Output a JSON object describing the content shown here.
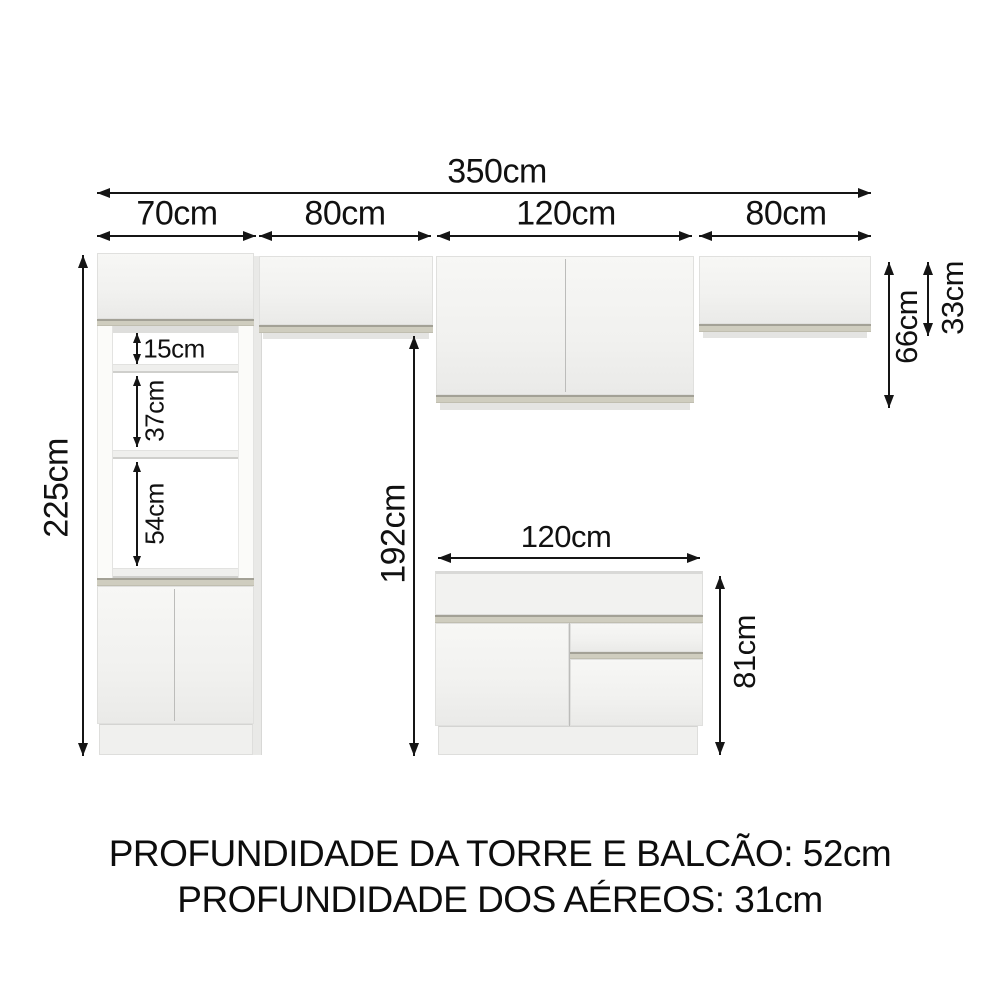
{
  "dims": {
    "total_width": "350cm",
    "tower_width": "70cm",
    "aereo_left_width": "80cm",
    "aereo_center_width": "120cm",
    "aereo_right_width": "80cm",
    "tower_height": "225cm",
    "shelf_gap_top": "15cm",
    "shelf_gap_middle": "37cm",
    "shelf_gap_bottom": "54cm",
    "clearance_height": "192cm",
    "aereo_center_height": "66cm",
    "aereo_right_height": "33cm",
    "balcao_width": "120cm",
    "balcao_height": "81cm"
  },
  "footer": {
    "line1": "PROFUNDIDADE DA TORRE E BALCÃO: 52cm",
    "line2": "PROFUNDIDADE DOS AÉREOS: 31cm"
  },
  "colors": {
    "background": "#ffffff",
    "dimension_lines": "#151515",
    "cabinet_face": "#f3f3f1",
    "edge_strip": "#cfcdbf"
  }
}
